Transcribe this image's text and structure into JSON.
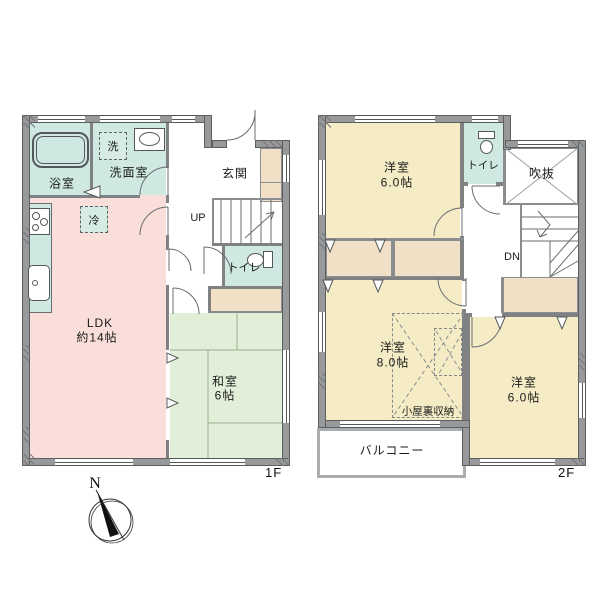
{
  "floor1": {
    "label": "1F",
    "bathroom": "浴室",
    "washer": "洗",
    "washroom": "洗面室",
    "entrance": "玄関",
    "stairs_up": "UP",
    "toilet": "トイレ",
    "fridge": "冷",
    "ldk_name": "LDK",
    "ldk_size": "約14帖",
    "washitsu_name": "和室",
    "washitsu_size": "6帖"
  },
  "floor2": {
    "label": "2F",
    "bedroom_north_name": "洋室",
    "bedroom_north_size": "6.0帖",
    "toilet": "トイレ",
    "void": "吹抜",
    "stairs_down": "DN",
    "bedroom_west_name": "洋室",
    "bedroom_west_size": "8.0帖",
    "attic_storage": "小屋裏収納",
    "bedroom_east_name": "洋室",
    "bedroom_east_size": "6.0帖",
    "balcony": "バルコニー"
  },
  "compass": {
    "north": "N"
  },
  "colors": {
    "ldk_pink": "#f9ded9",
    "wet_area_teal": "#cfe9e2",
    "tatami_green": "#e2efd8",
    "bedroom_yellow": "#f5ecc6",
    "closet_tan": "#f1dfc6",
    "wall_gray": "#97999b"
  }
}
